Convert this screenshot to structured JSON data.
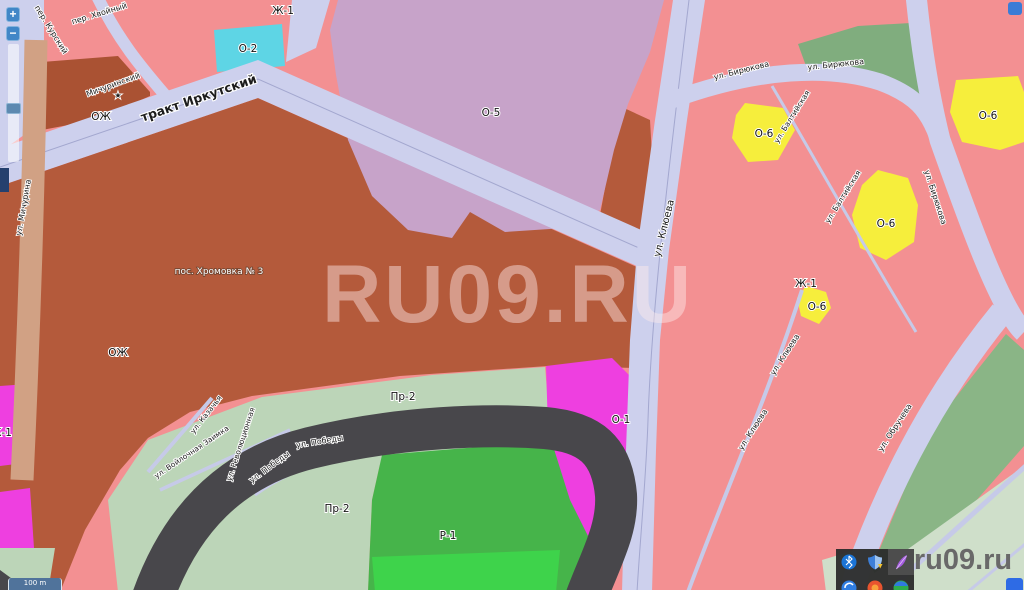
{
  "site": {
    "watermark": "RU09.RU",
    "logo": "ru09.ru"
  },
  "controls": {
    "zoom_in": "+",
    "zoom_out": "−",
    "scale_label": "100 m"
  },
  "map": {
    "zone_labels": [
      {
        "text": "Ж-1"
      },
      {
        "text": "О-2"
      },
      {
        "text": "О-5"
      },
      {
        "text": "ОЖ"
      },
      {
        "text": "ОЖ"
      },
      {
        "text": "О-6"
      },
      {
        "text": "О-6"
      },
      {
        "text": "Ж-1"
      },
      {
        "text": "О-6"
      },
      {
        "text": "О-6"
      },
      {
        "text": "О-1"
      },
      {
        "text": "Пр-2"
      },
      {
        "text": "Пр-2"
      },
      {
        "text": "Р-1"
      },
      {
        "text": "Ж-1"
      }
    ],
    "street_labels": [
      {
        "text": "тракт Иркутский"
      },
      {
        "text": "ул. Мичурина"
      },
      {
        "text": "пер. Курский"
      },
      {
        "text": "пер. Хвойный"
      },
      {
        "text": "Мичуринский"
      },
      {
        "text": "ул. Клюева"
      },
      {
        "text": "ул. Клюева"
      },
      {
        "text": "ул. Клюева"
      },
      {
        "text": "ул. Бирюкова"
      },
      {
        "text": "ул. Бирюкова"
      },
      {
        "text": "ул. Бирюкова"
      },
      {
        "text": "ул. Балтийская"
      },
      {
        "text": "ул. Балтийская"
      },
      {
        "text": "ул. Обручева"
      },
      {
        "text": "ул. Победы"
      },
      {
        "text": "ул. Победы"
      },
      {
        "text": "ул. Революционная"
      },
      {
        "text": "ул. Казачья"
      },
      {
        "text": "ул. Войлочная Заимка"
      }
    ],
    "settlement_labels": [
      {
        "text": "пос. Хромовка № 3"
      }
    ],
    "markers": [
      {
        "symbol": "★"
      }
    ]
  },
  "tray_icons": [
    {
      "name": "bluetooth-icon"
    },
    {
      "name": "defender-shield-icon"
    },
    {
      "name": "feather-icon"
    },
    {
      "name": "browser-icon-blue"
    },
    {
      "name": "browser-icon-red"
    },
    {
      "name": "browser-icon-green"
    }
  ],
  "colors": {
    "road": "#cdd0ed",
    "zone_residential_pink": "#f39092",
    "zone_ozh_brown": "#b45a3b",
    "zone_ozh_dark": "#aa5233",
    "zone_o5_plum": "#c7a3c9",
    "zone_o2_cyan": "#5ed5e5",
    "zone_o6_yellow": "#f6ee3c",
    "zone_green_school": "#80ad7e",
    "zone_green_se": "#8ab586",
    "zone_green_pale": "#cfdfca",
    "zone_pr2_sage": "#bcd5b8",
    "zone_r1_green": "#46b44a",
    "zone_r1_bright": "#3ed34b",
    "river_dark": "#48474b",
    "zone_magenta": "#ee3fe0",
    "zone_navy": "#25406e",
    "watermark": "rgba(255,236,236,0.45)",
    "ui_blue": "#4187c7",
    "logo_gray": "#696969"
  }
}
